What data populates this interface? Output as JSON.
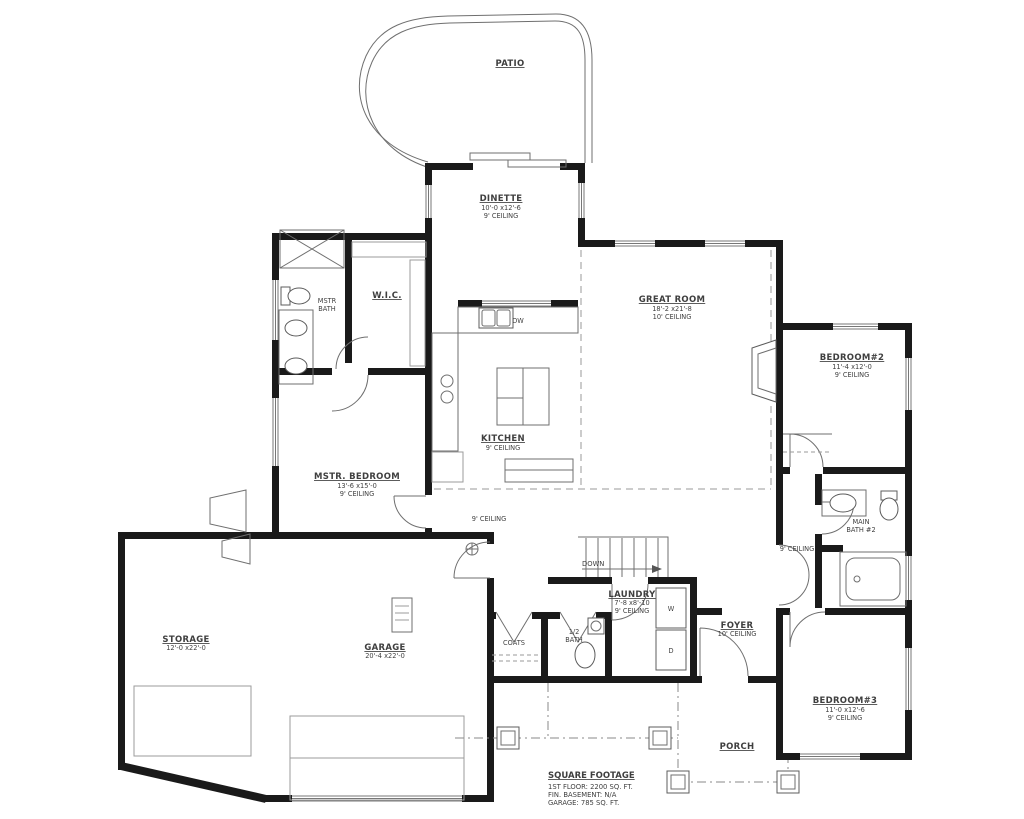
{
  "plan": {
    "background": "#ffffff",
    "wall_color": "#1a1a1a",
    "text_color": "#3f3f3f",
    "rooms": {
      "patio": {
        "name": "PATIO"
      },
      "dinette": {
        "name": "DINETTE",
        "dims": "10'-0 x12'-6",
        "ceiling": "9' CEILING"
      },
      "great_room": {
        "name": "GREAT ROOM",
        "dims": "18'-2 x21'-8",
        "ceiling": "10' CEILING"
      },
      "bedroom2": {
        "name": "BEDROOM#2",
        "dims": "11'-4 x12'-0",
        "ceiling": "9' CEILING"
      },
      "kitchen": {
        "name": "KITCHEN",
        "ceiling": "9' CEILING"
      },
      "mstr_bedroom": {
        "name": "MSTR. BEDROOM",
        "dims": "13'-6 x15'-0",
        "ceiling": "9' CEILING"
      },
      "mstr_bath": {
        "line1": "MSTR",
        "line2": "BATH"
      },
      "wic": {
        "name": "W.I.C."
      },
      "storage": {
        "name": "STORAGE",
        "dims": "12'-0 x22'-0"
      },
      "garage": {
        "name": "GARAGE",
        "dims": "20'-4 x22'-0"
      },
      "laundry": {
        "name": "LAUNDRY",
        "dims": "7'-8 x8'-10",
        "ceiling": "9' CEILING"
      },
      "half_bath": {
        "line1": "1/2",
        "line2": "BATH"
      },
      "coats": {
        "name": "COATS"
      },
      "foyer": {
        "name": "FOYER",
        "ceiling": "10' CEILING"
      },
      "bedroom3": {
        "name": "BEDROOM#3",
        "dims": "11'-0 x12'-6",
        "ceiling": "9' CEILING"
      },
      "main_bath": {
        "line1": "MAIN",
        "line2": "BATH #2"
      },
      "porch": {
        "name": "PORCH"
      }
    },
    "annotations": {
      "hall_ceiling_kitchen": "9' CEILING",
      "hall_ceiling_bedrooms": "9' CEILING",
      "stairs_down": "DOWN",
      "dishwasher": "DW",
      "washer": "W",
      "dryer": "D"
    },
    "square_footage": {
      "title": "SQUARE FOOTAGE",
      "first_floor": "1ST FLOOR: 2200 SQ. FT.",
      "basement": "FIN. BASEMENT: N/A",
      "garage": "GARAGE: 785 SQ. FT."
    }
  }
}
